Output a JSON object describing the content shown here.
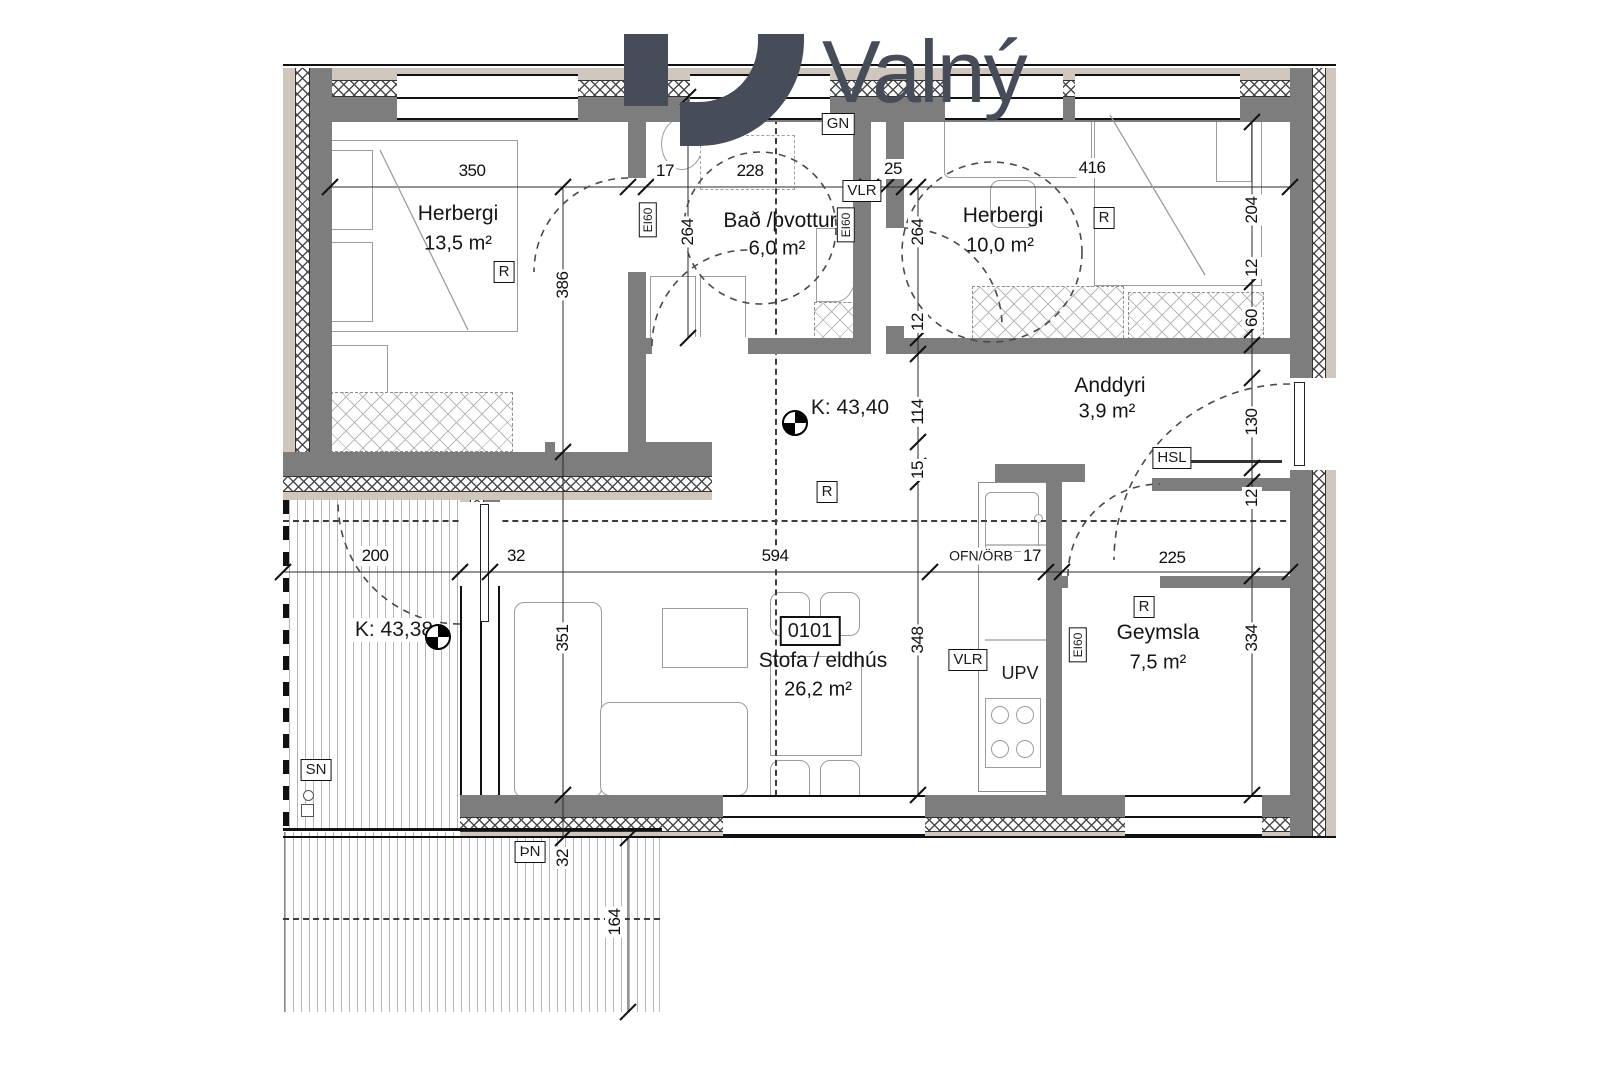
{
  "logo": {
    "text": "Valný"
  },
  "plan": {
    "unit_box": "0101",
    "rooms": {
      "herbergi1": {
        "name": "Herbergi",
        "area": "13,5 m²"
      },
      "bad": {
        "name": "Bað /þvottur",
        "area": "6,0 m²"
      },
      "herbergi2": {
        "name": "Herbergi",
        "area": "10,0 m²"
      },
      "anddyri": {
        "name": "Anddyri",
        "area": "3,9 m²"
      },
      "stofa": {
        "name": "Stofa / eldhús",
        "area": "26,2 m²"
      },
      "geymsla": {
        "name": "Geymsla",
        "area": "7,5 m²"
      }
    },
    "levels": {
      "k1": "K: 43,40",
      "k2": "K: 43,38"
    },
    "tags": {
      "gn": "GN",
      "vlr": "VLR",
      "r": "R",
      "hsl": "HSL",
      "sn": "SN",
      "thn": "ÞN",
      "upv": "UPV",
      "ofn": "OFN/ÖRB",
      "ei60": "EI60"
    },
    "dimensions": {
      "d350": "350",
      "d17a": "17",
      "d228": "228",
      "d25": "25",
      "d416": "416",
      "d264a": "264",
      "d264b": "264",
      "d386": "386",
      "d204": "204",
      "d12a": "12",
      "d60": "60",
      "d12b": "12",
      "d114": "114",
      "d15": "15",
      "d130": "130",
      "d12c": "12",
      "d200": "200",
      "d32a": "32",
      "d594": "594",
      "d17b": "17",
      "d225": "225",
      "d351": "351",
      "d348": "348",
      "d334": "334",
      "d32b": "32",
      "d164": "164"
    }
  },
  "colors": {
    "wall": "#7d7d7d",
    "cladding": "#cfc7bd",
    "logo": "#464c58",
    "line": "#1c1c1c"
  }
}
